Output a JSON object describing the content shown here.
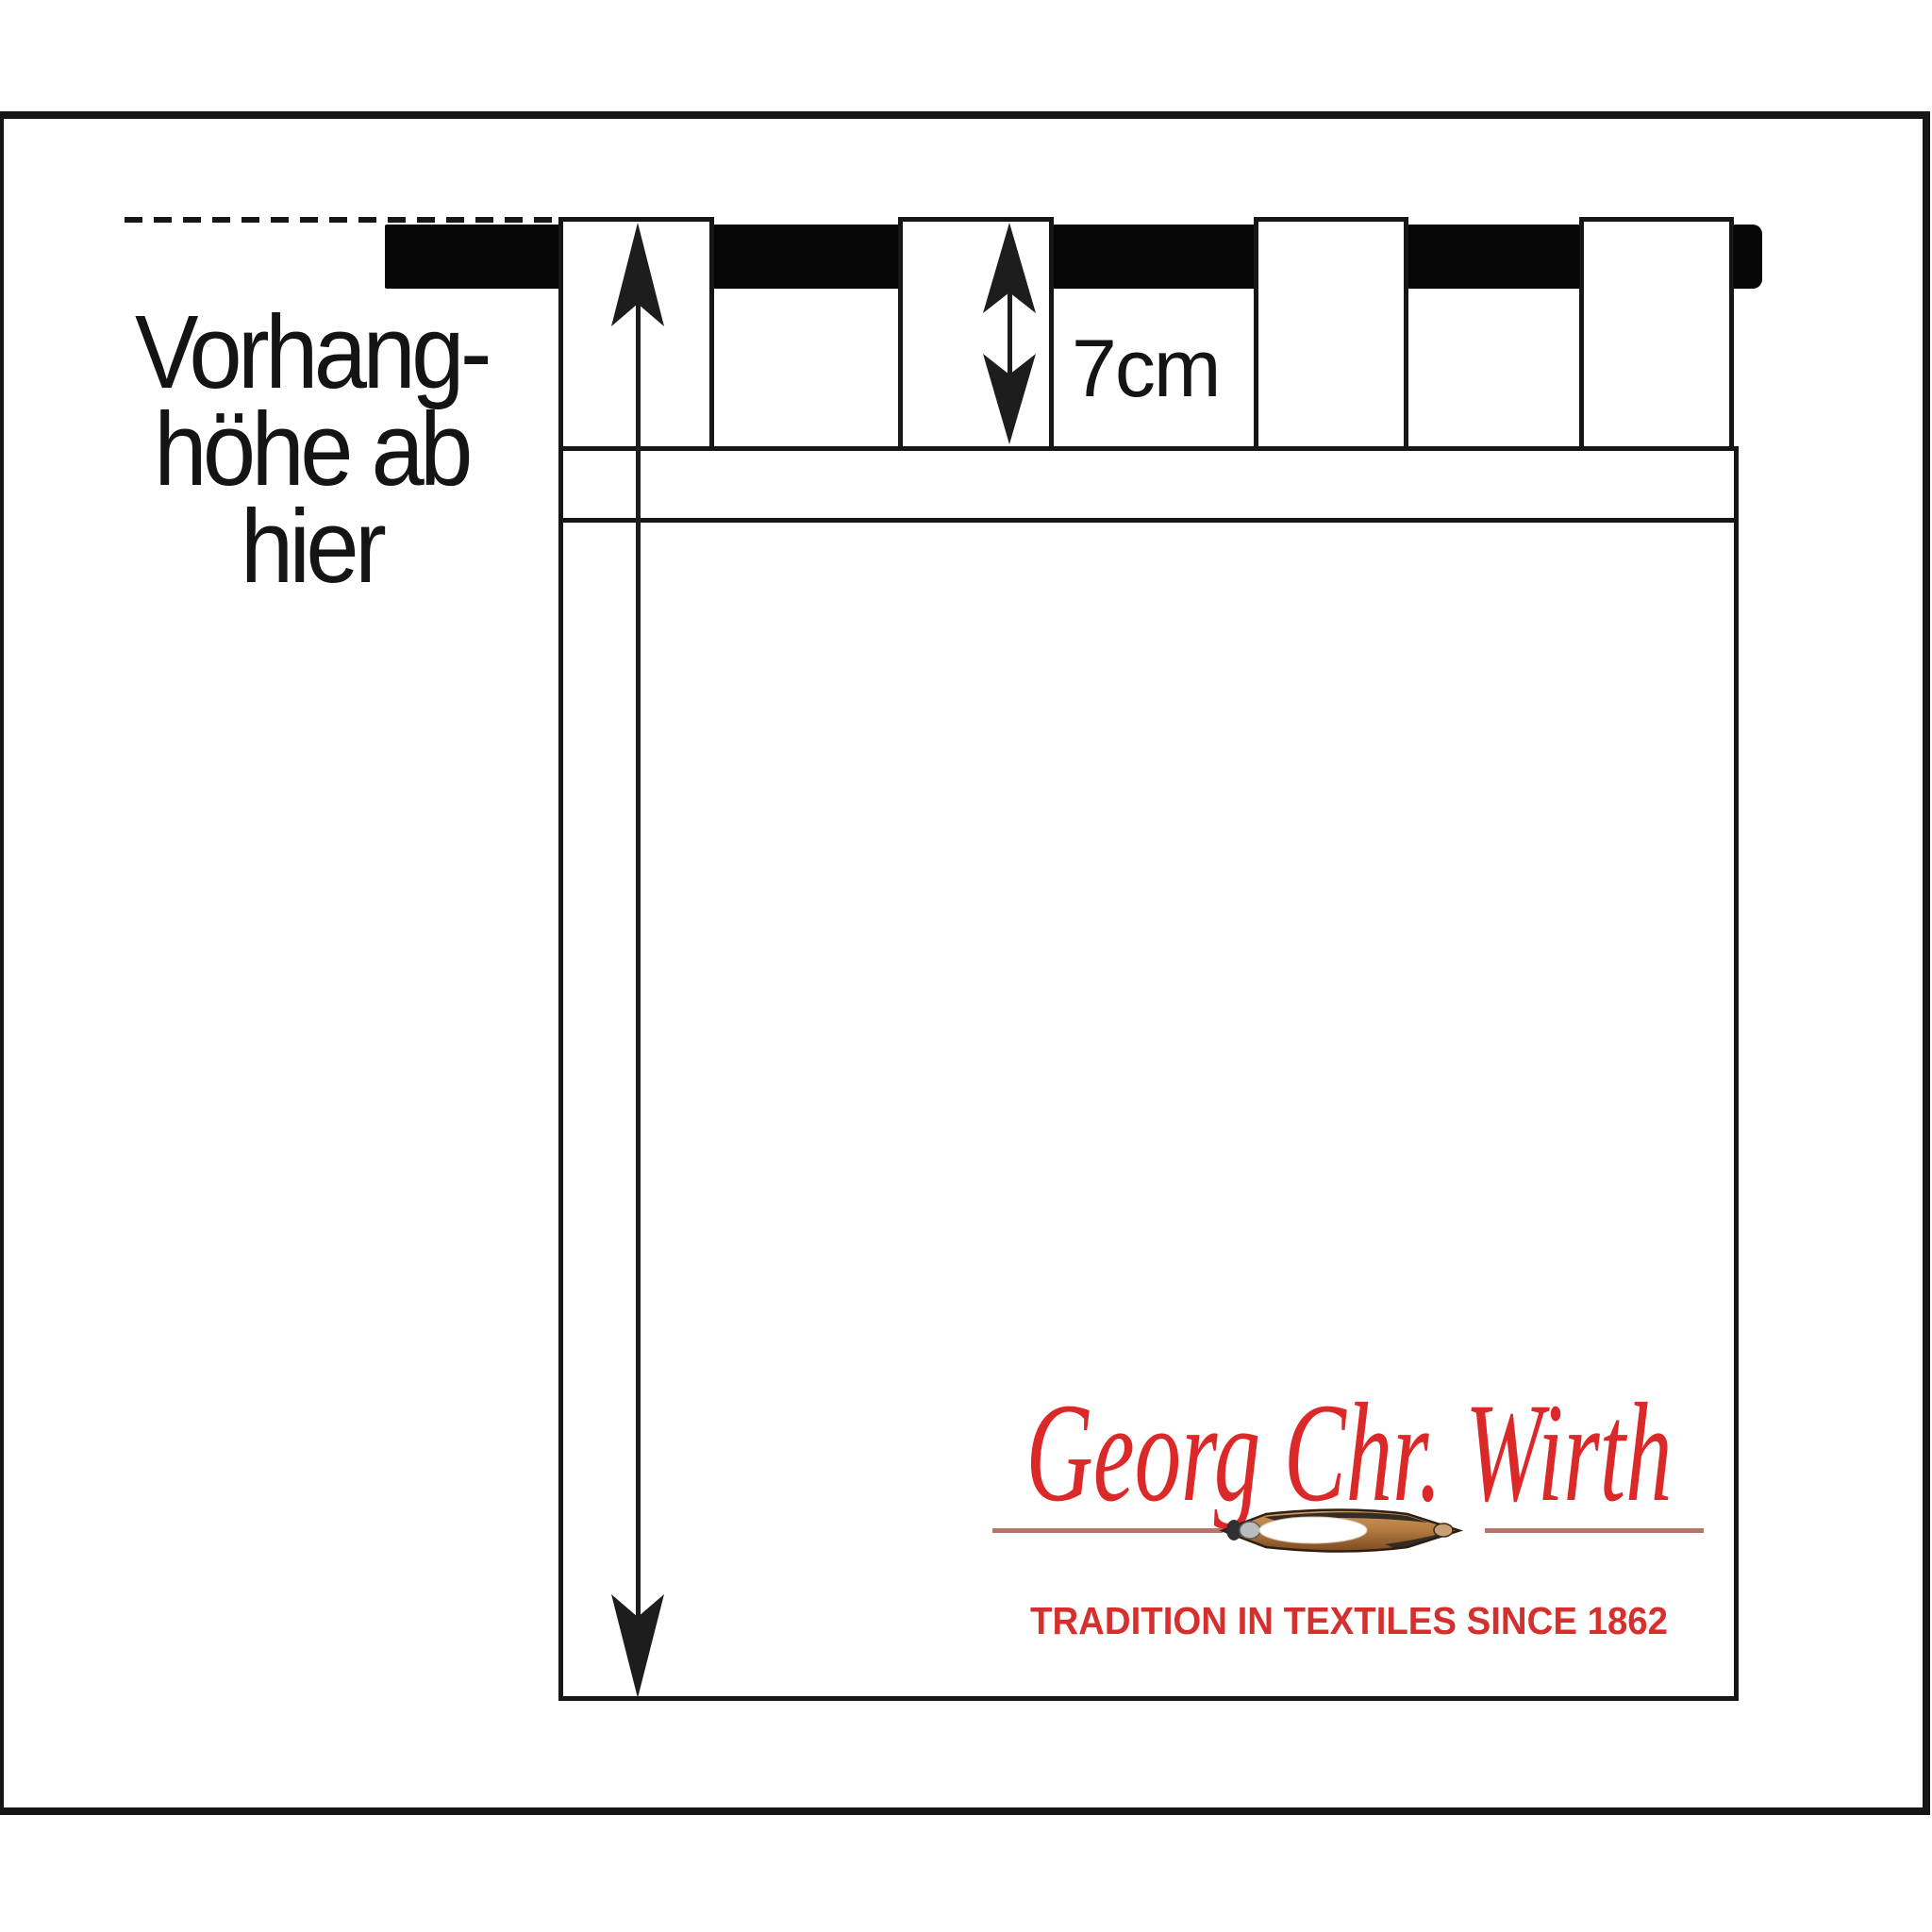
{
  "page": {
    "background": "#ffffff"
  },
  "diagram": {
    "frame_color": "#161616",
    "rod_color": "#060606",
    "annotation": {
      "line1": "Vorhang-",
      "line2": "höhe ab",
      "line3": "hier"
    },
    "tab_height_label": "7cm",
    "logo": {
      "title": "Georg Chr. Wirth",
      "tagline": "TRADITION IN TEXTILES SINCE 1862",
      "title_color": "#da2928",
      "tagline_color": "#d4302e",
      "divider_color": "#b5766b",
      "shuttle_icon": "sewing-shuttle"
    }
  }
}
